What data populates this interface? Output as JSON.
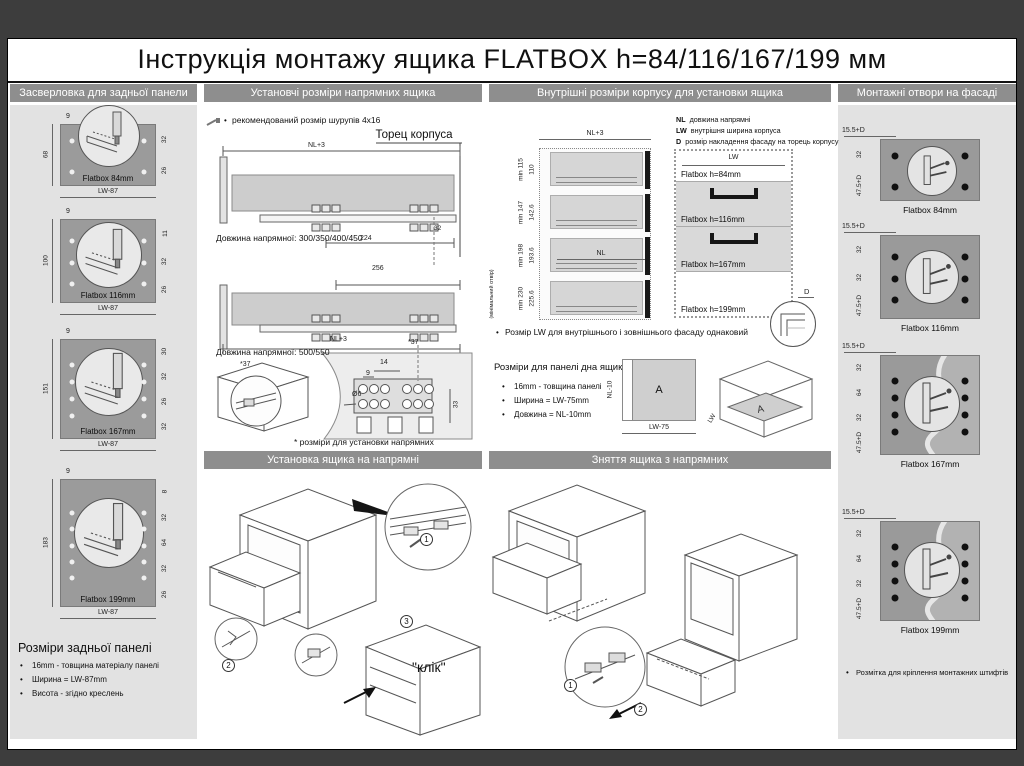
{
  "colors": {
    "frame": "#3d3d3d",
    "header_bar": "#8e8e8e",
    "column_bg": "#e2e2e2",
    "panel_gray": "#9b9b9b",
    "facade_gray": "#9a9a9a",
    "front_gray": "#d9d9d9"
  },
  "title": "Інструкція монтажу ящика FLATBOX h=84/116/167/199 мм",
  "back_panel": {
    "header": "Засверловка для задньої панели",
    "panels": [
      {
        "label": "Flatbox 84mm",
        "top_dim": "9",
        "left_dim": "68",
        "bottom_dim": "LW-87",
        "right_dims": [
          "32",
          "26"
        ]
      },
      {
        "label": "Flatbox 116mm",
        "top_dim": "9",
        "left_dim": "100",
        "bottom_dim": "LW-87",
        "right_dims": [
          "11",
          "32",
          "26"
        ]
      },
      {
        "label": "Flatbox 167mm",
        "top_dim": "9",
        "left_dim": "151",
        "bottom_dim": "LW-87",
        "right_dims": [
          "30",
          "32",
          "26",
          "32"
        ]
      },
      {
        "label": "Flatbox 199mm",
        "top_dim": "9",
        "left_dim": "183",
        "bottom_dim": "LW-87",
        "right_dims": [
          "8",
          "32",
          "64",
          "32",
          "26"
        ]
      }
    ],
    "footer_title": "Розміри задньої панелі",
    "footer_bullets": [
      "16mm - товщина матеріалу панелі",
      "Ширина = LW-87mm",
      "Висота - згідно креслень"
    ]
  },
  "rails": {
    "header": "Установчі розміри напрямних ящика",
    "screw_note": "рекомендований розмір шурупів 4x16",
    "body_end_label": "Торец корпуса",
    "dim_nl3": "NL+3",
    "dim_224": "224",
    "dim_32": "32",
    "dim_256": "256",
    "length_note_1": "Довжина напрямної:  300/350/400/450",
    "length_note_2": "Довжина напрямної:  500/550",
    "dim_star37": "*37",
    "dim_14": "14",
    "dim_9": "9",
    "dim_d6": "Ø6",
    "dim_33": "33",
    "caption": "* розміри для установки напрямних"
  },
  "body_dims": {
    "header": "Внутрішні розміри корпусу  для установки ящика",
    "legend": [
      {
        "abbr": "NL",
        "text": "довжина напрямні"
      },
      {
        "abbr": "LW",
        "text": "внутрішня ширина корпуса"
      },
      {
        "abbr": "D",
        "text": "розмір накладення фасаду на торець корпусу"
      }
    ],
    "dim_nl3": "NL+3",
    "dim_nl": "NL",
    "rows": [
      {
        "min": "min 115",
        "inner": "110"
      },
      {
        "min": "min 147",
        "inner": "142.6"
      },
      {
        "min": "min 198",
        "inner": "193.6"
      },
      {
        "min": "min 230",
        "inner": "225.6"
      }
    ],
    "min_note": "(мінімальний отвір)",
    "fronts": [
      "Flatbox h=84mm",
      "Flatbox h=116mm",
      "Flatbox h=167mm",
      "Flatbox h=199mm"
    ],
    "dim_lw": "LW",
    "dim_d": "D",
    "lw_note": "Розмір LW для внутрішнього і зовнішнього фасаду однаковий",
    "bottom_panel_title": "Розміри для панелі дна ящика",
    "bottom_panel_bullets": [
      "16mm - товщина панелі",
      "Ширина = LW-75mm",
      "Довжина = NL-10mm"
    ],
    "dim_nl10": "NL-10",
    "dim_lw75": "LW-75",
    "panel_letter": "A"
  },
  "facade": {
    "header": "Монтажні отвори на фасаді",
    "panels": [
      {
        "label": "Flatbox 84mm",
        "top_dim": "15.5+D",
        "left_dims": [
          "32",
          "47.5+D"
        ]
      },
      {
        "label": "Flatbox 116mm",
        "top_dim": "15.5+D",
        "left_dims": [
          "32",
          "32",
          "47.5+D"
        ]
      },
      {
        "label": "Flatbox 167mm",
        "top_dim": "15.5+D",
        "left_dims": [
          "32",
          "64",
          "32",
          "47.5+D"
        ]
      },
      {
        "label": "Flatbox 199mm",
        "top_dim": "15.5+D",
        "left_dims": [
          "32",
          "64",
          "32",
          "47.5+D"
        ]
      }
    ],
    "footer_note": "Розмітка для кріплення монтажних штифтів"
  },
  "install": {
    "header": "Установка ящика на напрямні",
    "click_label": "\"клік\"",
    "steps": [
      "1",
      "2",
      "3"
    ]
  },
  "remove": {
    "header": "Зняття ящика з напрямних",
    "steps": [
      "1",
      "2"
    ]
  }
}
